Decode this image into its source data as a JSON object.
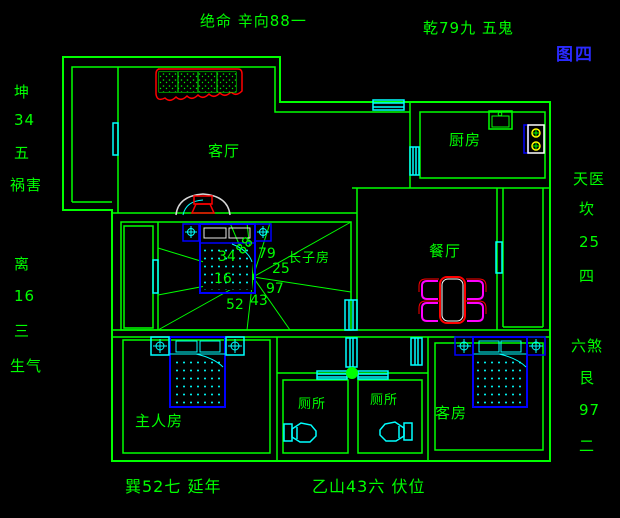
{
  "figure_label": "图四",
  "annotations": {
    "top_left": "绝命 辛向88一",
    "top_right": "乾79九 五鬼",
    "bottom_left": "巽52七 延年",
    "bottom_center": "乙山43六 伏位",
    "left": [
      "坤",
      "34",
      "五",
      "祸害",
      "离",
      "16",
      "三",
      "生气"
    ],
    "right": [
      "天医",
      "坎",
      "25",
      "四",
      "六煞",
      "艮",
      "97",
      "二"
    ]
  },
  "rooms": {
    "living_room": "客厅",
    "kitchen": "厨房",
    "dining_room": "餐厅",
    "eldest_son_room": "长子房",
    "master_bedroom": "主人房",
    "guest_room": "客房",
    "toilet_1": "厕所",
    "toilet_2": "厕所"
  },
  "compass_numbers": {
    "n88": "88",
    "n79": "79",
    "n25": "25",
    "n97": "97",
    "n43": "43",
    "n52": "52",
    "n16": "16",
    "n34": "34"
  },
  "colors": {
    "background": "#000000",
    "wall_green": "#00ff00",
    "window_cyan": "#00ffff",
    "furniture_blue": "#0000ff",
    "accent_red": "#ff0000",
    "chair_magenta": "#ff00ff",
    "burner_yellow": "#ffff00",
    "figure_label_blue": "#2a2aff"
  }
}
